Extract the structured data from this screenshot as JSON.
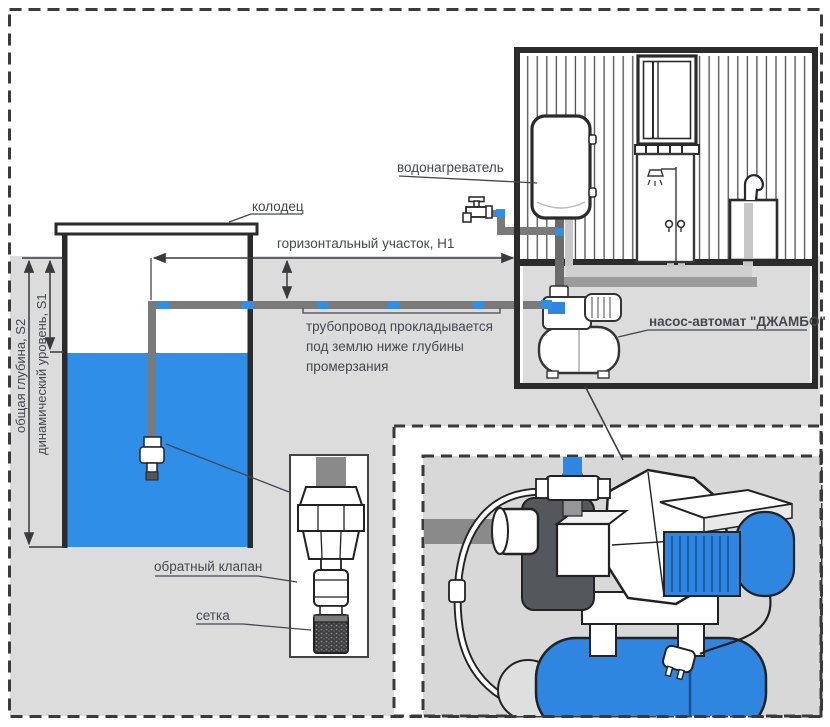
{
  "diagram": {
    "title_domain": "water-supply-scheme",
    "labels": {
      "well": "колодец",
      "water_heater": "водонагреватель",
      "horizontal_section": "горизонтальный участок, H1",
      "pipeline_note_line1": "трубопровод прокладывается",
      "pipeline_note_line2": "под землю ниже глубины",
      "pipeline_note_line3": "промерзания",
      "pump_station": "насос-автомат \"ДЖАМБО\"",
      "check_valve": "обратный клапан",
      "mesh": "сетка",
      "total_depth": "общая глубина, S2",
      "dynamic_level": "динамический уровень, S1"
    },
    "colors": {
      "water_blue": "#2F8EE8",
      "pump_blue": "#2E86E0",
      "ground_gray": "#DCDCDD",
      "pipe_gray": "#7A7A7A",
      "outline_dark": "#2B2B2B",
      "label_text": "#45474F"
    }
  }
}
